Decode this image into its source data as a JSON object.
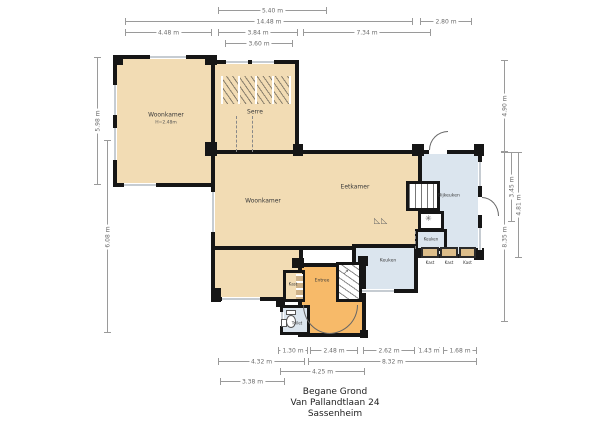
{
  "title": {
    "lines": [
      "Begane Grond",
      "Van Pallandtlaan 24",
      "Sassenheim"
    ]
  },
  "rooms": {
    "woonkamer_links": {
      "label": "Woonkamer",
      "sublabel": "H=2.48m"
    },
    "serre": {
      "label": "Serre"
    },
    "woonkamer": {
      "label": "Woonkamer"
    },
    "eetkamer": {
      "label": "Eetkamer"
    },
    "bijkeuken": {
      "label": "Bijkeuken"
    },
    "keuken_klein": {
      "label": "Keuken"
    },
    "keuken": {
      "label": "Keuken"
    },
    "entree": {
      "label": "Entree"
    },
    "kast": {
      "label": "Kast"
    },
    "toilet": {
      "label": "Toilet"
    },
    "kast_units": [
      {
        "label": "Kast"
      },
      {
        "label": "Kast"
      },
      {
        "label": "Kast"
      }
    ]
  },
  "dimensions": {
    "top": [
      {
        "label": "5.40 m"
      },
      {
        "label": "14.48 m"
      },
      {
        "label": "2.80 m"
      },
      {
        "label": "4.48 m"
      },
      {
        "label": "3.84 m"
      },
      {
        "label": "7.34 m"
      },
      {
        "label": "3.60 m"
      }
    ],
    "bottom": [
      {
        "label": "1.30 m"
      },
      {
        "label": "2.48 m"
      },
      {
        "label": "2.62 m"
      },
      {
        "label": "1.43 m"
      },
      {
        "label": "1.68 m"
      },
      {
        "label": "4.32 m"
      },
      {
        "label": "8.32 m"
      },
      {
        "label": "4.25 m"
      },
      {
        "label": "3.38 m"
      }
    ],
    "left": [
      {
        "label": "5.98 m"
      },
      {
        "label": "6.08 m"
      }
    ],
    "right": [
      {
        "label": "4.90 m"
      },
      {
        "label": "8.35 m"
      },
      {
        "label": "3.45 m"
      },
      {
        "label": "4.81 m"
      }
    ]
  },
  "icons": {
    "stairs_arrow": "↗",
    "ventilation": "✳",
    "counter": "◺◺"
  },
  "colors": {
    "room_beige": "#f2dcb4",
    "room_orange": "#f7ba69",
    "room_blue": "#dbe5ee",
    "wall": "#161616",
    "dim_line": "#9a9a9a",
    "cabinet": "#dcbd8a"
  }
}
